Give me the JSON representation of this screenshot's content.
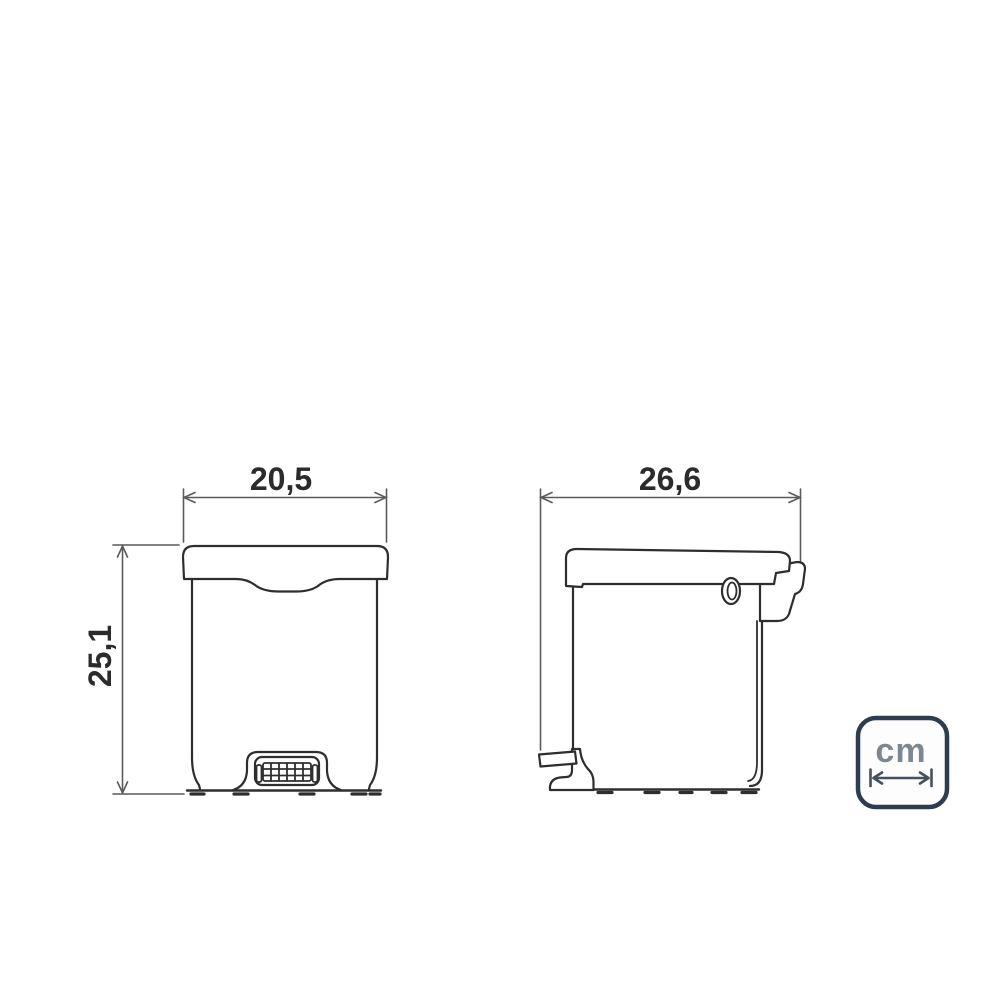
{
  "page": {
    "background": "#ffffff",
    "description": "Technical dimension drawing of a pedal waste bin, front and side views"
  },
  "front_view": {
    "width_dimension": {
      "value": "20,5"
    },
    "height_dimension": {
      "value": "25,1"
    }
  },
  "side_view": {
    "width_dimension": {
      "value": "26,6"
    }
  },
  "unit_badge": {
    "label": "cm",
    "border_color": "#2d3c4e",
    "label_color": "#7d8791",
    "arrow_color": "#46505b",
    "fill_color": "#fdfdfe"
  },
  "style": {
    "outline_color": "#2e2e2e",
    "dimension_line_color": "#5a5a5a",
    "dimension_text_color": "#2b2b2b"
  }
}
